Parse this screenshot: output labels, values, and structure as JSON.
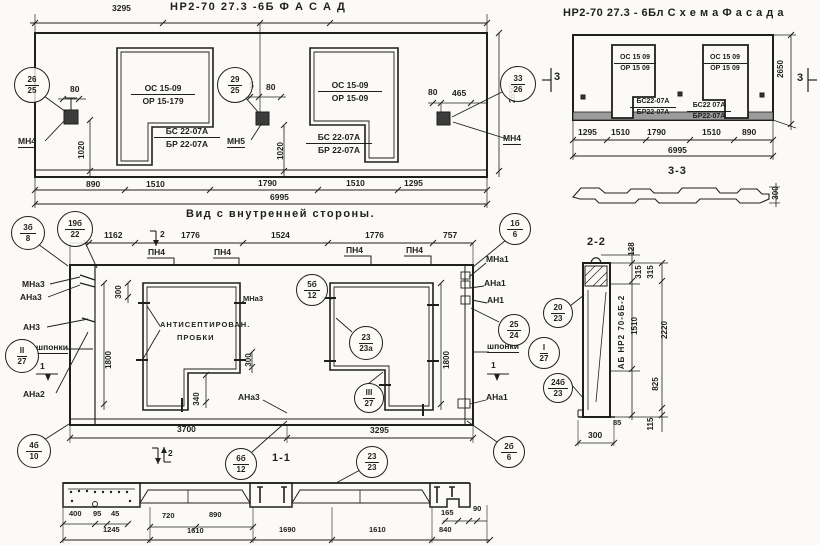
{
  "colors": {
    "ink": "#1f1f1f",
    "paper": "#fbfaf6",
    "shade": "#9b9b9b"
  },
  "facade": {
    "title": "НР2-70 27.3 -6Б    Ф А С А Д",
    "dim_top": "3295",
    "w1": {
      "t": "ОС 15-09",
      "b": "ОР 15-179"
    },
    "w1s": {
      "t": "БС 22-07А",
      "b": "БР 22-07А"
    },
    "w2": {
      "t": "ОС 15-09",
      "b": "ОР 15-09"
    },
    "w2s": {
      "t": "БС 22-07А",
      "b": "БР 22-07А"
    },
    "anchor_left": "МН4",
    "anchor_mid": "МН5",
    "anchor_right": "МН4",
    "d80l": "80",
    "d1020l": "1020",
    "d5": "5",
    "d80m": "80",
    "d1020m": "1020",
    "d80r": "80",
    "d465": "465",
    "d2650": "2650",
    "b1": "890",
    "b2": "1510",
    "b3": "1790",
    "b4": "1510",
    "b5": "1295",
    "total": "6995"
  },
  "scheme": {
    "title": "НР2-70 27.3 - 6Бл   С х е м а  Ф а с а д а",
    "w1": {
      "t": "ОС 15 09",
      "b": "ОР 15 09"
    },
    "w2": {
      "t": "ОС 15 09",
      "b": "ОР 15 09"
    },
    "w1s": {
      "t": "БС22-07А",
      "b": "БР22-07А"
    },
    "w2s": {
      "t": "БС22 07А",
      "b": "БР22-07А"
    },
    "mark3": "3",
    "d2650": "2650",
    "b1": "1295",
    "b2": "1510",
    "b3": "1790",
    "b4": "1510",
    "b5": "890",
    "total": "6995",
    "sec_label": "3-3",
    "d300": "300"
  },
  "inner": {
    "title": "Вид с внутренней стороны.",
    "t1": "1162",
    "t2": "1776",
    "t3": "1524",
    "t4": "1776",
    "t5": "757",
    "pn4": "ПН4",
    "mna3": "МНа3",
    "ana3l": "АНа3",
    "an3": "АН3",
    "shponki": "шпонки",
    "ana2": "АНа2",
    "mna1": "МНа1",
    "ana1": "АНа1",
    "an1": "АН1",
    "ana1b": "АНа1",
    "mna3b": "МНа3",
    "ana3r": "АНа3",
    "plug1": "АНТИСЕПТИРОВАН.",
    "plug2": "ПРОБКИ",
    "d300a": "300",
    "d300b": "300",
    "d340": "340",
    "d1800l": "1800",
    "d1800r": "1800",
    "b1": "3700",
    "b2": "3295",
    "m1": "1",
    "m2": "2"
  },
  "sec22": {
    "title": "2-2",
    "stamp": "АБ НР2 70-6Б-2",
    "d128": "128",
    "d315a": "315",
    "d315b": "315",
    "d1510": "1510",
    "d2220": "2220",
    "d825": "825",
    "d85": "85",
    "d115": "115",
    "d300": "300"
  },
  "sec11": {
    "title": "1-1",
    "r1": [
      "400",
      "95",
      "45",
      "720",
      "890",
      "165",
      "90"
    ],
    "r2": [
      "1245",
      "1610",
      "1690",
      "1610",
      "840"
    ]
  },
  "callouts": {
    "f1": {
      "t": "26",
      "b": "25"
    },
    "f2": {
      "t": "29",
      "b": "25"
    },
    "f3": {
      "t": "33",
      "b": "26"
    },
    "i1": {
      "t": "3б",
      "b": "8"
    },
    "i2": {
      "t": "19б",
      "b": "22"
    },
    "i3": {
      "t": "1б",
      "b": "6"
    },
    "i4": {
      "t": "5б",
      "b": "12"
    },
    "i5": {
      "t": "23",
      "b": "23а"
    },
    "i6": {
      "t": "II",
      "b": "27"
    },
    "i7": {
      "t": "III",
      "b": "27"
    },
    "i8": {
      "t": "I",
      "b": "27"
    },
    "i9": {
      "t": "25",
      "b": "24"
    },
    "i10": {
      "t": "2б",
      "b": "6"
    },
    "i11": {
      "t": "4б",
      "b": "10"
    },
    "s1": {
      "t": "6б",
      "b": "12"
    },
    "s2": {
      "t": "23",
      "b": "23"
    },
    "x1": {
      "t": "20",
      "b": "23"
    },
    "x2": {
      "t": "24б",
      "b": "23"
    }
  }
}
